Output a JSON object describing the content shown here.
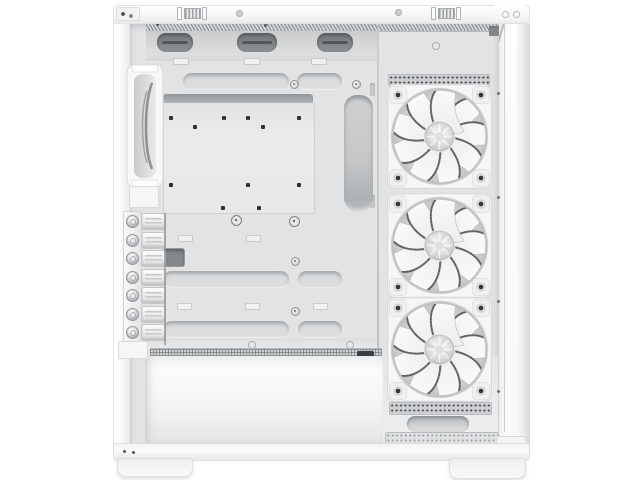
{
  "meta": {
    "type": "product-photo",
    "subject": "White ATX mid-tower PC case shown from the open side: interior with motherboard tray, PSU shroud, seven PCI slot covers, one rear exhaust fan and three white front intake fans behind an opened front glass panel",
    "background": "plain white"
  },
  "colors": {
    "bg": "#ffffff",
    "case-white": "#f8f9fa",
    "tray": "#e1e3e5",
    "recess": "#c9cbcd",
    "cutout-dark": "#8e9193",
    "vent-dark": "#3b3e40",
    "screw-dark": "#2e3032",
    "blade-edge": "#55585a",
    "hub-silver": "#cdcfd1"
  },
  "case": {
    "color": "white",
    "view": "interior side view, rear panel on the left, front fan wall on the right",
    "front_fans": {
      "count": 3,
      "color": "white",
      "blades_per_fan": 9,
      "label": "Three white front intake fans"
    },
    "rear_fan": {
      "count": 1,
      "color": "white",
      "label": "Rear exhaust fan"
    },
    "pci_slots": {
      "count": 7,
      "style": "vented covers with thumbscrews",
      "label": "Seven PCI expansion slot covers"
    },
    "features": [
      "motherboard tray with standoff holes",
      "rubber-grommet cable routing cutouts",
      "full-length PSU shroud with vent strip",
      "top mesh ventilation strip",
      "perforated bottom dust filter",
      "two case feet",
      "opened front glass panel"
    ]
  }
}
